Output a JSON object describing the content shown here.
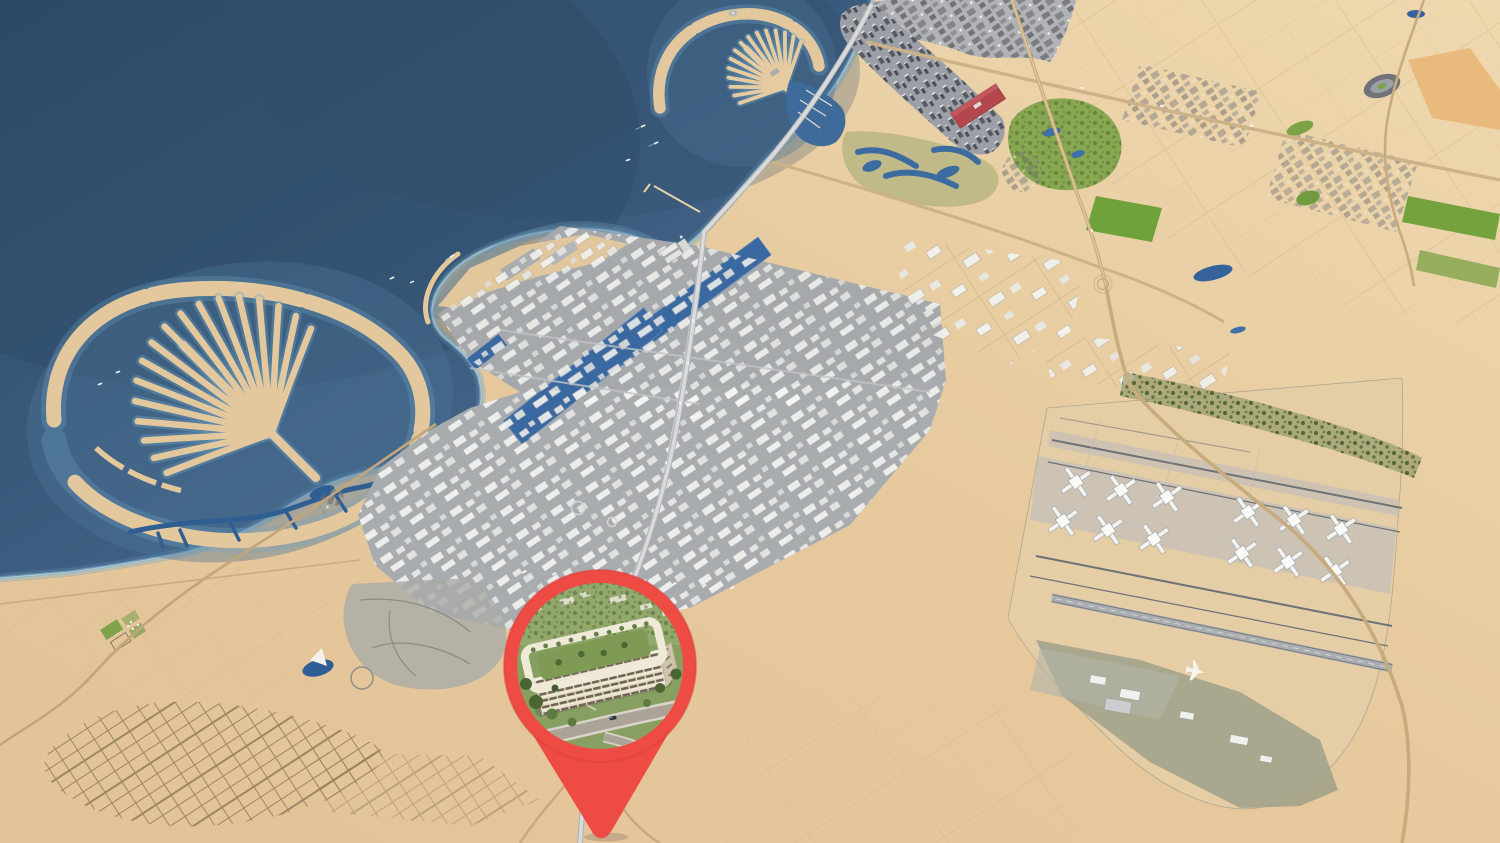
{
  "scene": {
    "type": "3d-aerial-map-render",
    "visible_text": [],
    "colors": {
      "sea_deep": "#304C68",
      "sea": "#3A5A7C",
      "sea_shallow": "#7FB2CD",
      "sand": "#E6C99D",
      "sand_light": "#EFD8AF",
      "urban_gray": "#A5A8AB",
      "harbor_water": "#3A68A0",
      "vegetation": "#7CA247",
      "tree_dark": "#465A2C",
      "airport_apron": "#E5CDA6",
      "cargo_olive": "#A5A48B",
      "red_venue": "#B3474D",
      "pin_red": "#EF4B45"
    },
    "features": [
      "sea",
      "coastline-with-shallow-glow",
      "palm-shaped-island-small",
      "palm-shaped-island-large",
      "coastal-high-rise-strip",
      "dense-city-blocks",
      "container-port-with-two-basins",
      "free-zone-warehouses",
      "industrial-plots",
      "airport-x-shaped-concourses",
      "runways",
      "forest-strip",
      "cargo-terminal-with-airplane",
      "desert-plot-grid",
      "suburb-street-grid",
      "canals",
      "golf-greens",
      "lakes",
      "location-pin"
    ]
  },
  "pin": {
    "icon": "location-pin-icon",
    "color": "#EF4B45",
    "photo": "circular-aerial-render-of-courtyard-apartment-building-with-gardens-and-road"
  }
}
